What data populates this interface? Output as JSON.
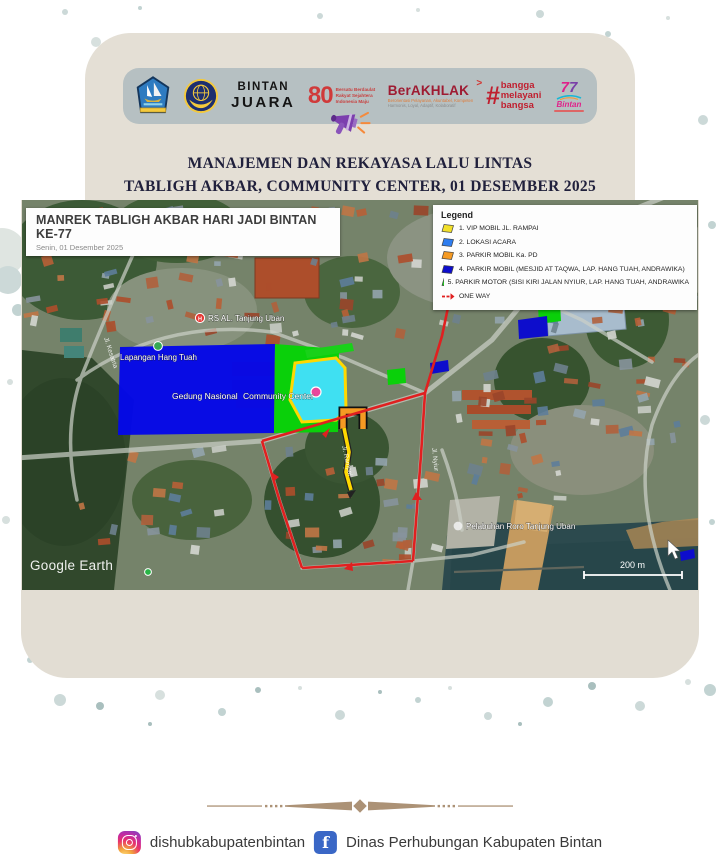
{
  "header": {
    "title_line1": "MANAJEMEN DAN REKAYASA LALU LINTAS",
    "title_line2": "TABLIGH AKBAR, COMMUNITY CENTER, 01 DESEMBER 2025",
    "logos": {
      "bintan_juara": [
        "BINTAN",
        "JUARA"
      ],
      "indonesia_80": {
        "number": "80",
        "lines": [
          "Bersatu Berdaulat",
          "Rakyat Sejahtera",
          "Indonesia Maju"
        ]
      },
      "berakhlak": {
        "title": "BerAKHLAK",
        "arrow": ">",
        "sub1": "Berorientasi Pelayanan, Akuntabel, Kompeten",
        "sub2": "Harmonis, Loyal, Adaptif, Kolaboratif"
      },
      "bangga": {
        "hash": "#",
        "words": [
          "bangga",
          "melayani",
          "bangsa"
        ]
      },
      "bintan77": {
        "digit1": "7",
        "digit2": "7",
        "name": "Bintan"
      }
    }
  },
  "map": {
    "title": "MANREK TABLIGH AKBAR HARI JADI BINTAN KE-77",
    "subtitle": "Senin, 01 Desember 2025",
    "legend": {
      "heading": "Legend",
      "items": [
        {
          "label": "1. VIP MOBIL JL. RAMPAI",
          "color": "#f2e02a"
        },
        {
          "label": "2. LOKASI ACARA",
          "color": "#2e7df0"
        },
        {
          "label": "3. PARKIR MOBIL Ka. PD",
          "color": "#f59a23"
        },
        {
          "label": "4. PARKIR MOBIL (MESJID AT TAQWA, LAP. HANG TUAH, ANDRAWIKA)",
          "color": "#0d0dcc"
        },
        {
          "label": "5. PARKIR MOTOR (SISI KIRI JALAN NYIUR, LAP. HANG TUAH, ANDRAWIKA",
          "color": "#1ecf1e"
        }
      ],
      "one_way": "ONE WAY",
      "one_way_color": "#e02020"
    },
    "labels": {
      "hospital": "RS AL. Tanjung Uban",
      "field": "Lapangan Hang Tuah",
      "gedung": "Gedung Nasional",
      "community": "Community Center",
      "port": "Pelabuhan Roro Tanjung Uban",
      "street_1": "Jl. Kesatria",
      "street_2": "Jl. Rampai",
      "street_3": "Jl. Nyiur"
    },
    "watermark": "Google Earth",
    "scale_label": "200 m"
  },
  "footer": {
    "instagram_handle": "dishubkabupatenbintan",
    "facebook_name": "Dinas Perhubungan Kabupaten Bintan"
  }
}
